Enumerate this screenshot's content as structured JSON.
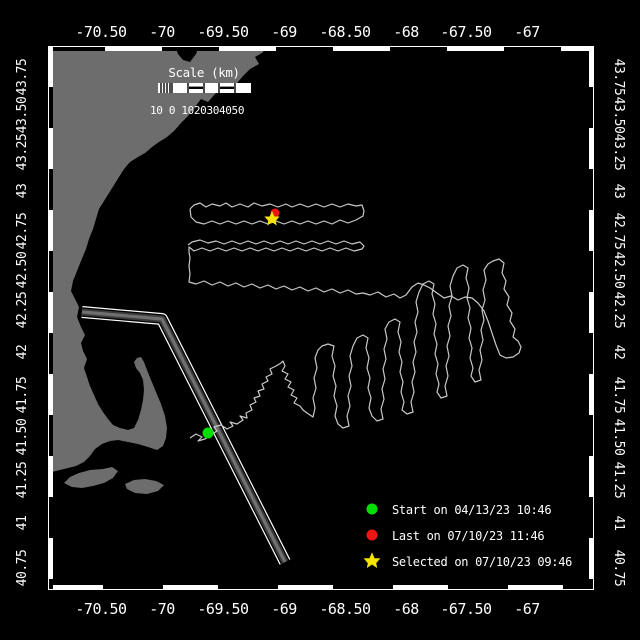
{
  "colors": {
    "background": "#000000",
    "land": "#6d6d6d",
    "track": "#c8c8c8",
    "frame": "#ffffff",
    "start_green": "#00dd00",
    "last_red": "#ee1414",
    "selected_yellow": "#f5e400",
    "lane_dark": "#3a3a3a",
    "lane_light": "#707070"
  },
  "axes": {
    "top_labels": [
      "-70.50",
      "-70",
      "-69.50",
      "-69",
      "-68.50",
      "-68",
      "-67.50",
      "-67"
    ],
    "bottom_labels": [
      "-70.50",
      "-70",
      "-69.50",
      "-69",
      "-68.50",
      "-68",
      "-67.50",
      "-67"
    ],
    "left_labels": [
      "43.75",
      "43.50",
      "43.25",
      "43",
      "42.75",
      "42.50",
      "42.25",
      "42",
      "41.75",
      "41.50",
      "41.25",
      "41",
      "40.75"
    ],
    "right_labels": [
      "43.75",
      "43.50",
      "43.25",
      "43",
      "42.75",
      "42.50",
      "42.25",
      "42",
      "41.75",
      "41.50",
      "41.25",
      "41",
      "40.75"
    ]
  },
  "scale_bar": {
    "title": "Scale (km)",
    "tick_labels": "10 0 1020304050"
  },
  "legend": {
    "items": [
      {
        "marker": "start-dot",
        "color": "#00dd00",
        "label": "Start on 04/13/23 10:46"
      },
      {
        "marker": "last-dot",
        "color": "#ee1414",
        "label": "Last on 07/10/23 11:46"
      },
      {
        "marker": "selected-star",
        "color": "#f5e400",
        "label": "Selected on 07/10/23 09:46"
      }
    ]
  },
  "markers": {
    "map_start": "translate(208,433)",
    "map_last": "translate(275,213)",
    "map_selected": "translate(272,219)"
  },
  "geometry": {
    "coast": "M48,46 L175,46 L178,54 L183,60 L190,62 L196,54 L199,46 L268,46 L262,53 L255,57 L259,64 L250,69 L243,76 L237,83 L230,89 L222,87 L215,94 L208,102 L201,99 L195,107 L188,116 L181,123 L174,131 L167,137 L159,142 L152,147 L145,153 L138,157 L130,162 L124,169 L119,177 L114,185 L109,193 L104,201 L99,209 L96,219 L93,229 L89,239 L86,249 L81,261 L77,271 L73,281 L71,291 L75,299 L79,307 L77,317 L81,327 L85,335 L81,343 L83,351 L87,359 L84,368 L87,377 L90,386 L94,395 L98,404 L103,412 L108,419 L113,425 L120,428 L128,430 L134,428 L138,420 L141,410 L143,400 L144,390 L143,380 L140,373 L136,368 L134,362 L137,358 L141,357 L144,362 L147,370 L151,380 L156,392 L161,404 L165,416 L167,428 L166,438 L163,446 L157,450 L148,447 L138,444 L128,442 L118,440 L110,441 L102,444 L95,449 L90,456 L84,462 L76,466 L68,468 L60,470 L52,472 L48,473 Z",
    "island_marthas_vineyard": "M64,483 L70,477 L79,473 L90,470 L103,469 L112,467 L118,471 L113,478 L104,483 L93,486 L82,488 L72,487 Z",
    "island_nantucket": "M127,489 L125,484 L134,480 L145,479 L156,481 L164,485 L158,491 L147,494 L135,493 Z",
    "shipping_lane": "M82,312 L162,319 L285,562",
    "track_survey_box": "M190,209 L194,205 L200,203 L206,207 L212,204 L220,206 L226,203 L232,207 L240,204 L248,207 L254,203 L262,206 L270,204 L278,207 L286,204 L292,207 L300,204 L308,207 L316,204 L324,207 L332,204 L340,207 L348,204 L356,206 L362,205 L364,211 L363,216 L356,220 L348,223 L340,220 L332,224 L324,221 L316,224 L308,221 L300,224 L292,221 L284,224 L276,221 L268,224 L260,221 L252,224 L244,221 L236,224 L228,221 L220,224 L212,221 L204,224 L196,222 L191,217 L190,209 M188,245 L192,242 L200,240 L208,243 L216,241 L224,244 L232,241 L240,244 L248,241 L256,244 L264,241 L272,244 L280,241 L288,244 L296,241 L304,244 L312,241 L320,244 L328,241 L336,244 L344,241 L352,244 L360,242 L364,246 L362,249 L354,251 L346,248 L338,251 L330,248 L322,251 L314,248 L306,251 L298,248 L290,251 L282,248 L274,251 L266,248 L258,251 L250,248 L242,251 L234,248 L226,251 L218,248 L210,251 L202,248 L194,251 L189,247 L189,252 L190,258 L189,266 L190,274 L189,282 L196,284 L204,281 L212,285 L220,282 L228,286 L236,283 L244,287 L252,284 L260,288 L268,285 L276,289 L284,286 L292,290 L300,287 L308,291 L316,288 L324,292 L332,289 L340,293 L348,290 L356,294 L363,293 L370,295 L378,292 L386,297 L394,294 L400,298 L406,295 L412,287 L418,283",
    "track_transit_and_loops": "M190,438 L196,434 L202,437 L198,441 L205,439 L211,435 L217,431 L214,427 L221,425 L227,429 L233,426 L230,422 L237,424 L243,420 L240,416 L247,418 L246,413 L252,410 L250,405 L256,402 L254,398 L260,396 L258,391 L264,389 L262,384 L268,381 L266,377 L272,374 L270,369 L276,366 L281,363 L283,361 L285,366 L282,371 L288,374 L285,379 L291,382 L288,387 L294,390 L291,395 L297,398 L294,403 L300,406 L303,410 L307,413 L310,415 L313,417 L315,408 L313,398 L316,388 L314,378 L317,368 L315,358 L318,350 L322,346 L328,344 L334,346 L332,356 L335,366 L333,376 L336,386 L334,396 L337,406 L335,416 L338,424 L343,428 L349,426 L347,416 L350,406 L348,396 L351,386 L349,376 L352,366 L350,356 L353,346 L357,338 L363,335 L368,338 L366,348 L369,358 L367,368 L370,378 L368,388 L371,398 L369,408 L372,416 L377,421 L383,419 L381,409 L384,399 L382,389 L385,379 L383,369 L386,359 L384,349 L387,339 L385,329 L389,322 L395,319 L400,322 L398,332 L401,342 L399,352 L402,362 L400,372 L403,382 L401,392 L404,402 L402,410 L407,414 L413,412 L411,402 L414,392 L412,382 L415,372 L413,362 L416,352 L414,342 L417,332 L415,322 L418,312 L416,302 L419,292 L423,284 L429,281 L434,284 L432,294 L435,304 L433,314 L436,324 L434,334 L437,344 L435,354 L438,364 L436,374 L439,384 L437,392 L441,398 L447,396 L445,386 L448,376 L446,366 L449,356 L447,346 L450,336 L448,326 L451,316 L449,306 L452,296 L450,286 L453,276 L457,268 L463,265 L468,268 L466,278 L469,288 L467,298 L470,308 L468,318 L471,328 L469,338 L472,348 L470,358 L473,368 L471,376 L475,382 L481,380 L479,370 L482,360 L480,350 L483,340 L481,330 L484,320 L482,310 L485,300 L483,290 L486,280 L484,270 L488,264 L493,261 L499,259 L504,263 L502,273 L506,281 L504,289 L509,297 L507,305 L512,313 L510,321 L515,329 L513,337 L518,341 L521,347 L519,353 L513,357 L506,358 L500,355 L496,345 L492,333 L488,321 L484,311 L478,303 L472,298 L465,297 L458,300 L451,296 L444,298 L437,293 L430,288 L424,285 L418,283"
  }
}
